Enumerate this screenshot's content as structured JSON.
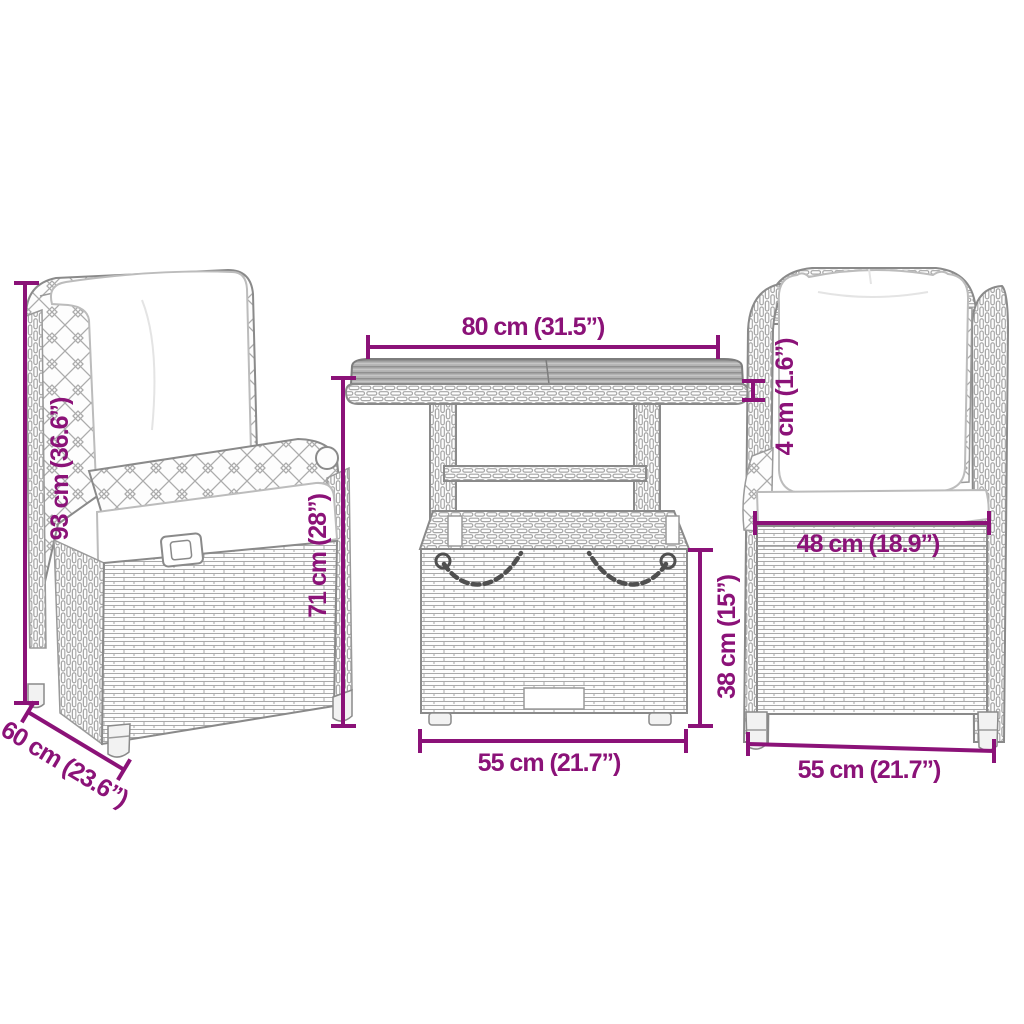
{
  "colors": {
    "dimension_accent": "#8b1278",
    "furniture_outline": "#8a8a8a",
    "tabletop_fill": "#b3b3b3",
    "cushion_fill": "#ffffff",
    "background": "#ffffff"
  },
  "labels": {
    "table_width": "80 cm (31.5”)",
    "chair_height": "93 cm (36.6”)",
    "chair_arm_height": "71 cm (28”)",
    "chair_depth": "60 cm (23.6”)",
    "tabletop_thickness": "4 cm (1.6”)",
    "seat_width": "48 cm (18.9”)",
    "table_base_height": "38 cm (15”)",
    "table_base_width": "55 cm (21.7”)",
    "chair_width": "55 cm (21.7”)"
  }
}
